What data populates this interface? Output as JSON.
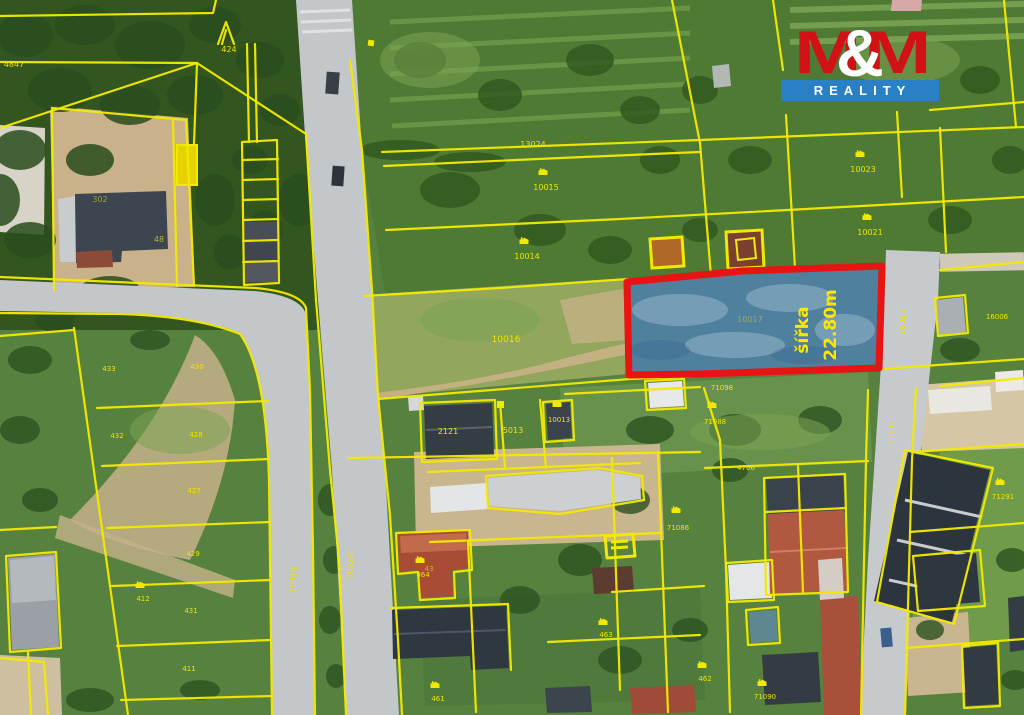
{
  "logo": {
    "m1": "M",
    "amp": "&",
    "m2": "M",
    "reality": "REALITY",
    "red": "#d01217",
    "blue": "#2a80c4"
  },
  "highlight": {
    "line1": "šířka",
    "line2": "22.80m",
    "parcel": "10017",
    "outline_color": "#e81313",
    "fill_color": "#4e81b4"
  },
  "map": {
    "colors": {
      "cadastral_yellow": "#f2e900",
      "label_yellow": "#efe400",
      "road_gray": "#c3c7ca",
      "forest_green": "#33551f",
      "grass_green": "#5d8745",
      "dirt_tan": "#c9b189"
    },
    "labels": [
      {
        "t": "4847",
        "x": 14,
        "y": 67,
        "s": 8
      },
      {
        "t": "424",
        "x": 229,
        "y": 52,
        "s": 8
      },
      {
        "t": "13024",
        "x": 533,
        "y": 147,
        "s": 8
      },
      {
        "t": "10015",
        "x": 546,
        "y": 190,
        "s": 8
      },
      {
        "t": "10014",
        "x": 527,
        "y": 259,
        "s": 8
      },
      {
        "t": "10016",
        "x": 506,
        "y": 342,
        "s": 9
      },
      {
        "t": "10023",
        "x": 863,
        "y": 172,
        "s": 8
      },
      {
        "t": "10021",
        "x": 870,
        "y": 235,
        "s": 8
      },
      {
        "t": "302",
        "x": 100,
        "y": 202,
        "s": 8,
        "c": "#9aa034"
      },
      {
        "t": "48",
        "x": 159,
        "y": 242,
        "s": 8,
        "c": "#b8ae36"
      },
      {
        "t": "433",
        "x": 109,
        "y": 371,
        "s": 7
      },
      {
        "t": "430",
        "x": 197,
        "y": 369,
        "s": 7
      },
      {
        "t": "432",
        "x": 117,
        "y": 438,
        "s": 7
      },
      {
        "t": "428",
        "x": 196,
        "y": 437,
        "s": 7
      },
      {
        "t": "427",
        "x": 194,
        "y": 493,
        "s": 7
      },
      {
        "t": "429",
        "x": 193,
        "y": 556,
        "s": 7
      },
      {
        "t": "431",
        "x": 191,
        "y": 613,
        "s": 7
      },
      {
        "t": "411",
        "x": 189,
        "y": 671,
        "s": 7
      },
      {
        "t": "2121",
        "x": 448,
        "y": 434,
        "s": 8
      },
      {
        "t": "5013",
        "x": 513,
        "y": 433,
        "s": 8
      },
      {
        "t": "10013",
        "x": 559,
        "y": 422,
        "s": 7
      },
      {
        "t": "71098",
        "x": 722,
        "y": 390,
        "s": 7
      },
      {
        "t": "71088",
        "x": 715,
        "y": 424,
        "s": 7
      },
      {
        "t": "4706",
        "x": 746,
        "y": 470,
        "s": 7
      },
      {
        "t": "71086",
        "x": 678,
        "y": 530,
        "s": 7
      },
      {
        "t": "71291",
        "x": 1003,
        "y": 499,
        "s": 7
      },
      {
        "t": "16006",
        "x": 997,
        "y": 319,
        "s": 7
      },
      {
        "t": "43",
        "x": 429,
        "y": 571,
        "s": 7,
        "c": "#c8b42e"
      },
      {
        "t": "464",
        "x": 423,
        "y": 577,
        "s": 7
      },
      {
        "t": "463",
        "x": 606,
        "y": 637,
        "s": 7
      },
      {
        "t": "462",
        "x": 705,
        "y": 681,
        "s": 7
      },
      {
        "t": "461",
        "x": 438,
        "y": 701,
        "s": 7
      },
      {
        "t": "412",
        "x": 143,
        "y": 601,
        "s": 7
      },
      {
        "t": "71090",
        "x": 765,
        "y": 699,
        "s": 7
      },
      {
        "t": "10022",
        "x": 905,
        "y": 322,
        "s": 8,
        "r": -90
      },
      {
        "t": "10018",
        "x": 894,
        "y": 434,
        "s": 7,
        "r": -90
      },
      {
        "t": "10020",
        "x": 353,
        "y": 566,
        "s": 8,
        "r": -86
      },
      {
        "t": "10019",
        "x": 296,
        "y": 580,
        "s": 8,
        "r": -87
      }
    ],
    "icons": [
      {
        "x": 543,
        "y": 175
      },
      {
        "x": 524,
        "y": 244
      },
      {
        "x": 860,
        "y": 157
      },
      {
        "x": 867,
        "y": 220
      },
      {
        "x": 712,
        "y": 408
      },
      {
        "x": 557,
        "y": 407
      },
      {
        "x": 420,
        "y": 563
      },
      {
        "x": 603,
        "y": 625
      },
      {
        "x": 702,
        "y": 668
      },
      {
        "x": 435,
        "y": 688
      },
      {
        "x": 676,
        "y": 513
      },
      {
        "x": 1000,
        "y": 485
      },
      {
        "x": 140,
        "y": 588
      },
      {
        "x": 762,
        "y": 686
      }
    ]
  }
}
